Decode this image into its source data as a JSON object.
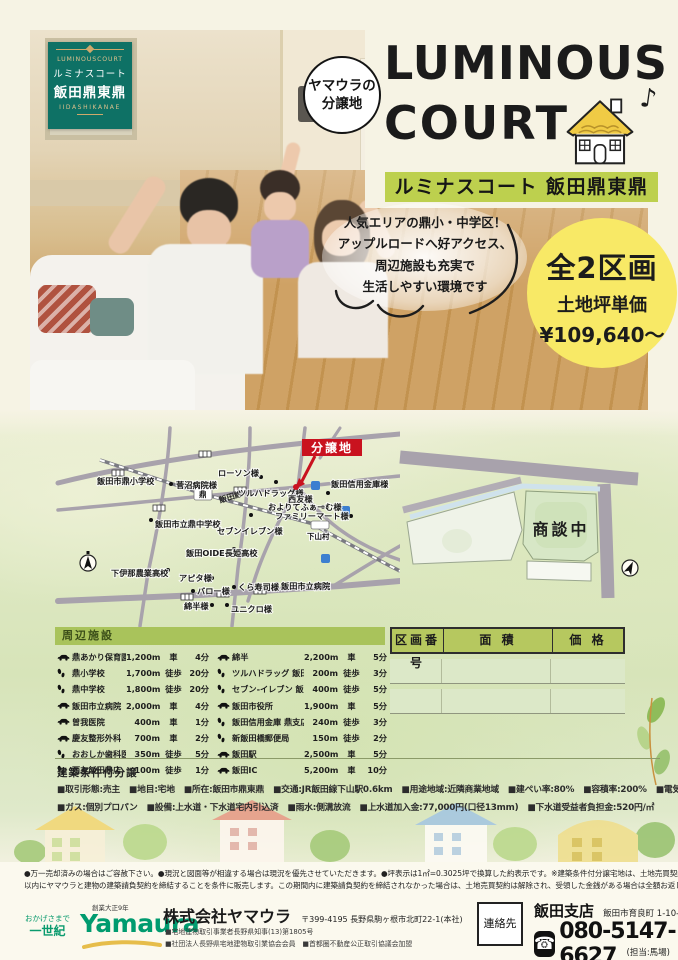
{
  "corner_badge": {
    "en": "LUMINOUSCOURT",
    "kana": "ルミナスコート",
    "name": "飯田鼎東鼎",
    "romaji": "IIDASHIKANAE"
  },
  "round_badge": {
    "line1": "ヤマウラの",
    "line2": "分譲地"
  },
  "title": {
    "line1": "LUMINOUS",
    "line2": "COURT",
    "music_note": "♪"
  },
  "subtitle_band": "ルミナスコート 飯田鼎東鼎",
  "speech_bubble": {
    "line1": "人気エリアの鼎小・中学区！",
    "line2": "アップルロードへ好アクセス、",
    "line3": "周辺施設も充実で",
    "line4": "生活しやすい環境です"
  },
  "price_badge": {
    "lots": "全2区画",
    "label": "土地坪単価",
    "price": "¥109,640〜"
  },
  "map": {
    "site_flag": "分譲地",
    "rail_line": "飯田線",
    "station_kanae": "鼎",
    "station_shimoyama": "下山村",
    "pois": [
      "飯田市鼎小学校",
      "菅沼病院様",
      "ローソン様",
      "ツルハドラッグ様",
      "西友様",
      "飯田信用金庫様",
      "およりてふぁーむ様",
      "ファミリーマート様",
      "飯田市立鼎中学校",
      "セブンイレブン様",
      "飯田OIDE長姫高校",
      "下伊那農業高校",
      "アピタ様",
      "バロー様",
      "くら寿司様",
      "飯田市立病院",
      "綿半様",
      "ユニクロ様"
    ]
  },
  "lot_diagram": {
    "status": "商談中"
  },
  "facilities": {
    "header": "周辺施設",
    "left": [
      {
        "icon": "car",
        "name": "鼎あかり保育園",
        "distance": "1,200m",
        "mode": "車",
        "time": "4分"
      },
      {
        "icon": "walk",
        "name": "鼎小学校",
        "distance": "1,700m",
        "mode": "徒歩",
        "time": "20分"
      },
      {
        "icon": "walk",
        "name": "鼎中学校",
        "distance": "1,800m",
        "mode": "徒歩",
        "time": "20分"
      },
      {
        "icon": "car",
        "name": "飯田市立病院",
        "distance": "2,000m",
        "mode": "車",
        "time": "4分"
      },
      {
        "icon": "car",
        "name": "曽我医院",
        "distance": "400m",
        "mode": "車",
        "time": "1分"
      },
      {
        "icon": "car",
        "name": "慶友整形外科",
        "distance": "700m",
        "mode": "車",
        "time": "2分"
      },
      {
        "icon": "walk",
        "name": "おおしか歯科医院",
        "distance": "350m",
        "mode": "徒歩",
        "time": "5分"
      },
      {
        "icon": "walk",
        "name": "西友飯田鼎店",
        "distance": "100m",
        "mode": "徒歩",
        "time": "1分"
      }
    ],
    "right": [
      {
        "icon": "car",
        "name": "綿半",
        "distance": "2,200m",
        "mode": "車",
        "time": "5分"
      },
      {
        "icon": "walk",
        "name": "ツルハドラッグ 飯田西鼎店",
        "distance": "200m",
        "mode": "徒歩",
        "time": "3分"
      },
      {
        "icon": "walk",
        "name": "セブン-イレブン 飯田水の手店",
        "distance": "400m",
        "mode": "徒歩",
        "time": "5分"
      },
      {
        "icon": "car",
        "name": "飯田市役所",
        "distance": "1,900m",
        "mode": "車",
        "time": "5分"
      },
      {
        "icon": "walk",
        "name": "飯田信用金庫 鼎支店",
        "distance": "240m",
        "mode": "徒歩",
        "time": "3分"
      },
      {
        "icon": "walk",
        "name": "新飯田橋郵便局",
        "distance": "150m",
        "mode": "徒歩",
        "time": "2分"
      },
      {
        "icon": "car",
        "name": "飯田駅",
        "distance": "2,500m",
        "mode": "車",
        "time": "5分"
      },
      {
        "icon": "car",
        "name": "飯田IC",
        "distance": "5,200m",
        "mode": "車",
        "time": "10分"
      }
    ]
  },
  "price_table": {
    "col1": "区画番号",
    "col2": "面 積",
    "col3": "価 格"
  },
  "terms": {
    "header": "建築条件付分譲",
    "row1": [
      "取引形態:売主",
      "地目:宅地",
      "所在:飯田市鼎東鼎",
      "交通:JR飯田線下山駅0.6km",
      "用途地域:近隣商業地域",
      "建ぺい率:80%",
      "容積率:200%",
      "電気:中部電力"
    ],
    "row2": [
      "ガス:個別プロパン",
      "設備:上水道・下水道宅内引込済",
      "雨水:側溝放流",
      "上水道加入金:77,000円(口径13mm)",
      "下水道受益者負担金:520円/㎡"
    ]
  },
  "disclaimer": {
    "line1": "●万一売却済みの場合はご容赦下さい。●現況と図面等が相違する場合は現況を優先させていただきます。●坪表示は1㎡=0.3025坪で換算した約表示です。※建築条件付分譲宅地は、土地売買契約後3ヶ月",
    "line2": "以内にヤマウラと建物の建築請負契約を締結することを条件に販売します。この期間内に建築請負契約を締結されなかった場合は、土地売買契約は解除され、受領した金銭がある場合は全額お返しします。"
  },
  "footer": {
    "tagline1": "おかげさまで",
    "tagline2": "一世紀",
    "since": "創業大正9年",
    "logo": "Yamaura",
    "company": "株式会社ヤマウラ",
    "head_office": "〒399-4195 長野県駒ヶ根市北町22-1(本社)",
    "license1": "■宅地建物取引事業者長野県知事(13)第1805号",
    "license2": "■社団法人長野県宅地建物取引業協会会員　■首都圏不動産公正取引協議会加盟",
    "contact_label": "連絡先",
    "branch": "飯田支店",
    "branch_address": "飯田市育良町 1-10-3",
    "phone": "080-5147-6627",
    "person": "(担当:馬場)"
  },
  "colors": {
    "badge_teal": "#0e7165",
    "band_green": "#bdd04e",
    "price_yellow": "#f8e966",
    "site_red": "#c9121f",
    "section_green": "#a9c35b",
    "logo_green": "#009b6f"
  }
}
